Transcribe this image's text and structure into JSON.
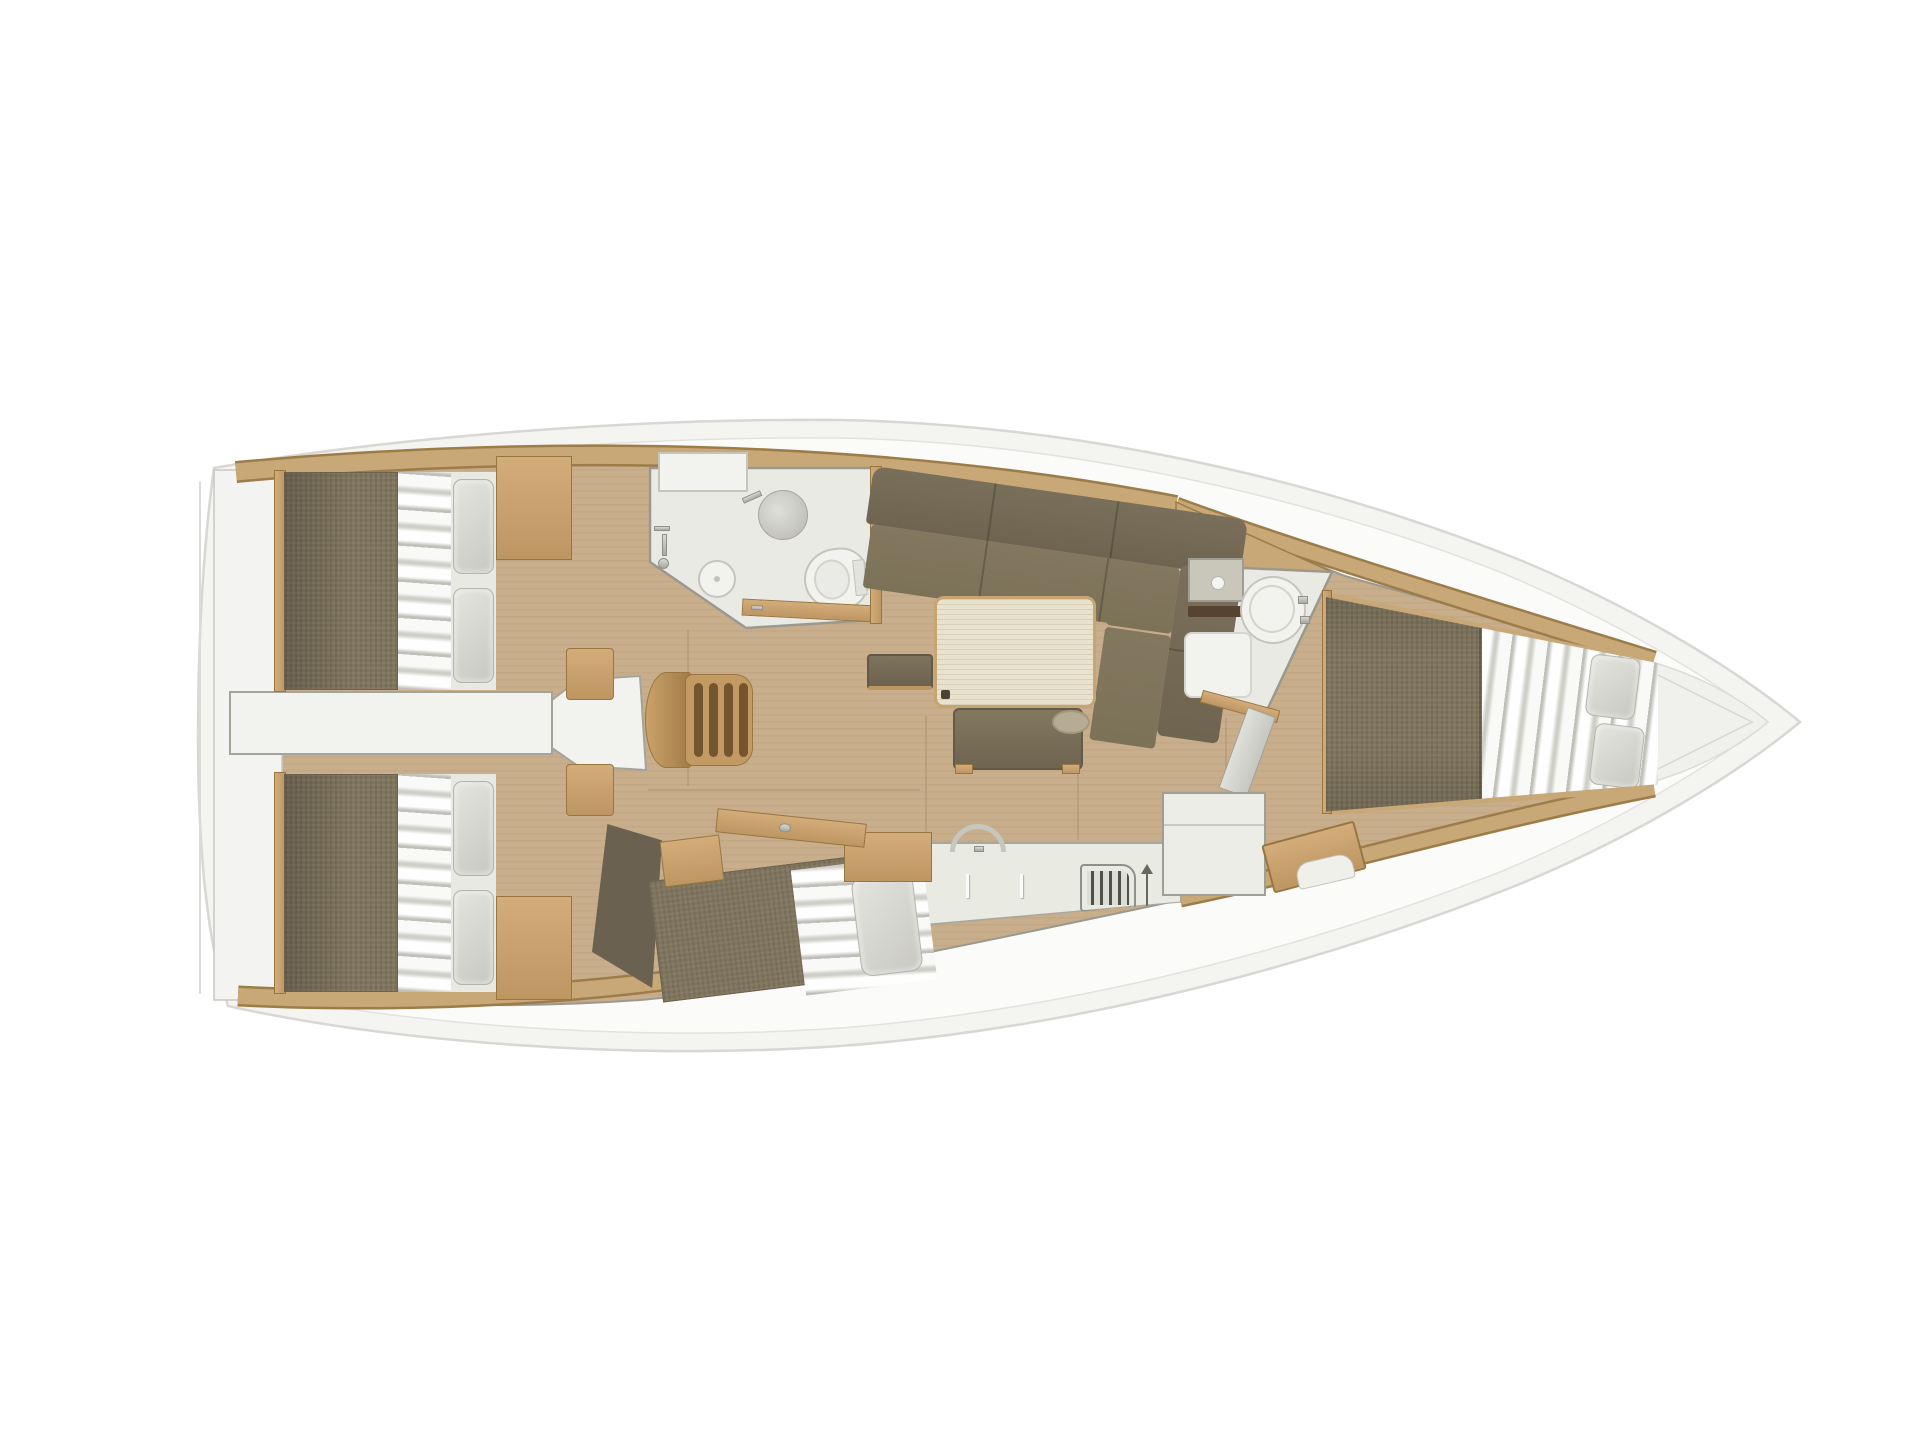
{
  "meta": {
    "type": "yacht-interior-floor-plan",
    "view": "top-down",
    "orientation": "bow-right",
    "rendered_text": "none"
  },
  "colors": {
    "hull": "#f4f4f1",
    "hull-edge": "#d8d7d3",
    "hull-rim": "#fbfbf9",
    "deck-wood": "#c8a877",
    "deck-wood-dark": "#9c7c48",
    "floor": "#c9ae8c",
    "floor-line": "#b3987a",
    "wall": "#9b998f",
    "room-floor": "#e9eae4",
    "fixture": "#f2f3ef",
    "fixture-edge": "#c5c5be",
    "mattress": "#80755e",
    "mattress-dark": "#6c6250",
    "sofa": "#7c7258",
    "sofa-dark": "#6e6450",
    "bedding": "#e9e9e4",
    "pillow": "#dcdcd6",
    "table-top": "#e9e2cf",
    "wood-hi": "#d3ac7a",
    "wood-lo": "#bd9662",
    "wood-edge": "#97763f",
    "stairs-wood": "#c49a63",
    "stairs-gap": "#74552f",
    "chrome": "#c2c3be",
    "vent-line": "#50504a",
    "white-box": "#ecede6",
    "bow-shade": "#f0f0ec"
  },
  "elements": {
    "hull": "sailing-yacht-hull",
    "aft-port-cabin": "double-berth-cabin",
    "aft-starboard-cabin": "double-berth-cabin",
    "single-berth": "angled-single-berth",
    "corridor": "aft-cabin-passage",
    "companionway": "wooden-stairs-4-treads",
    "port-head": "bathroom-shower-sink-toilet",
    "starboard-head": "bathroom-sink-toilet-shower-pan",
    "salon": "l-shaped-sofa-table-bench-stool",
    "galley": "counter-faucet-locker-vent",
    "refrigerator": "white-cabinet",
    "nav-station": "wood-console",
    "forward-cabin": "v-berth-double"
  }
}
